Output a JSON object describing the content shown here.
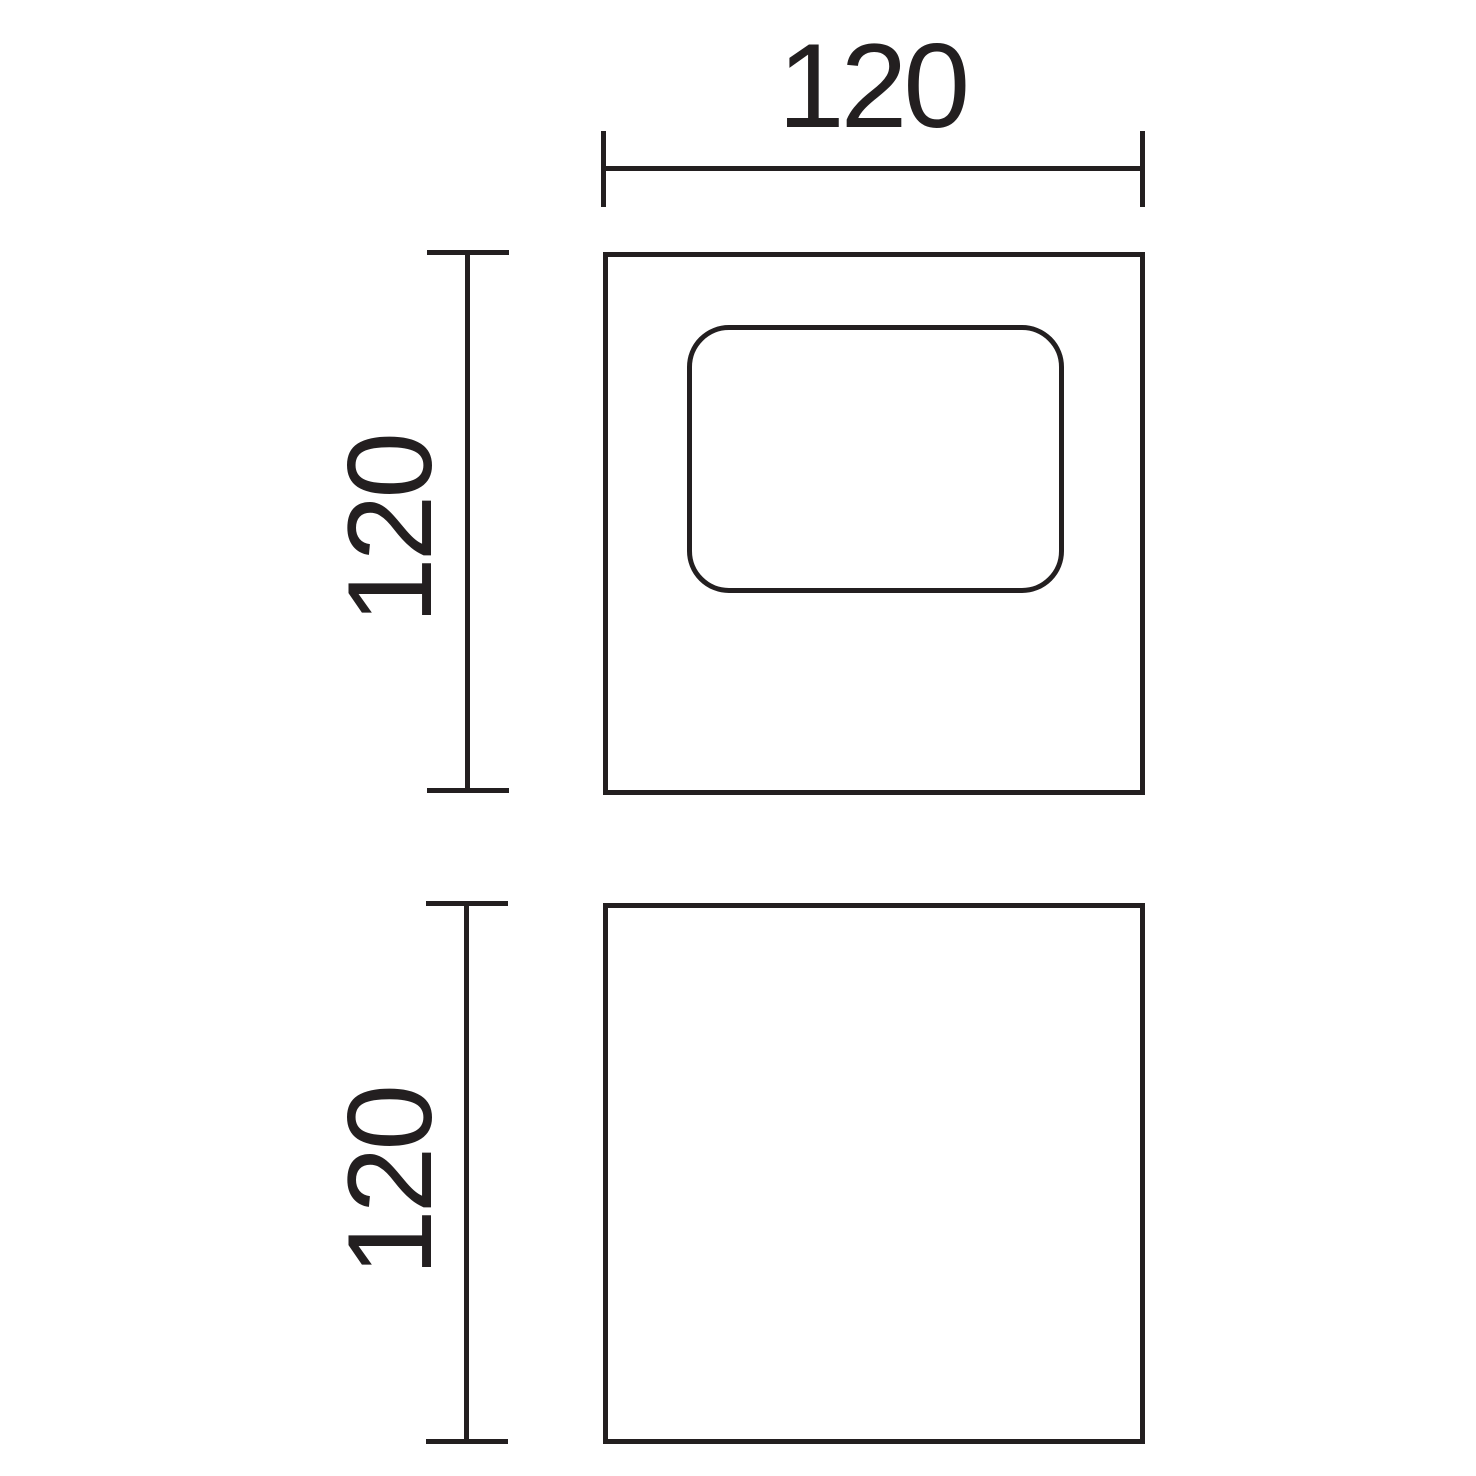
{
  "drawing": {
    "type": "technical-dimension-drawing",
    "views": {
      "front": {
        "name": "front view with window cutout",
        "shape": "square",
        "window_shape": "rounded rectangle"
      },
      "side": {
        "name": "side view",
        "shape": "square"
      }
    },
    "dimensions": {
      "top_width": {
        "value": "120"
      },
      "front_height": {
        "value": "120"
      },
      "side_height": {
        "value": "120"
      }
    }
  },
  "colors": {
    "ink": "#231f20",
    "background": "#ffffff"
  }
}
